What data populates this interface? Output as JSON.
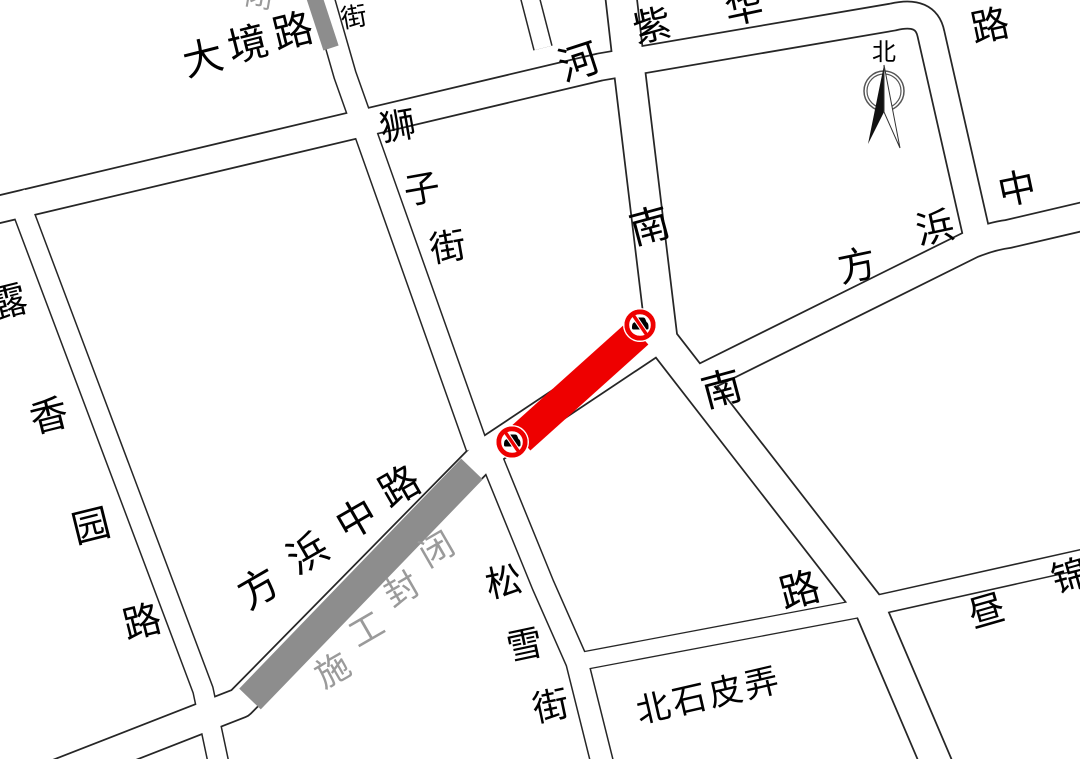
{
  "map": {
    "colors": {
      "background": "#ffffff",
      "road_outline": "#262626",
      "road_fill": "#ffffff",
      "closure_gray_band": "#8d8d8d",
      "closure_gray_text": "#9a9a9a",
      "closure_red": "#ee0000"
    },
    "compass": {
      "north_label": "北"
    },
    "closure": {
      "construction_text": "施工封闭",
      "construction_chars": [
        "施",
        "工",
        "封",
        "闭"
      ],
      "partial_top_char": "闭"
    },
    "icons": {
      "no_entry": "no-entry-sign"
    },
    "streets": {
      "dajing": {
        "name": "大境路",
        "chars": [
          "大",
          "境",
          "路"
        ]
      },
      "shizi": {
        "name": "狮子街",
        "chars": [
          "狮",
          "子",
          "街"
        ],
        "top_char": "街"
      },
      "henan": {
        "name": "河南南路",
        "chars": [
          "河",
          "南",
          "南",
          "路"
        ]
      },
      "zihua": {
        "name": "紫华路",
        "chars": [
          "紫",
          "华",
          "路"
        ]
      },
      "fangbang_west": {
        "name": "方浜中路",
        "chars": [
          "方",
          "浜",
          "中",
          "路"
        ]
      },
      "fangbang_east": {
        "chars": [
          "方",
          "浜",
          "中"
        ]
      },
      "luxiangyuan": {
        "name": "露香园路",
        "chars": [
          "露",
          "香",
          "园",
          "路"
        ]
      },
      "songxue": {
        "name": "松雪街",
        "chars": [
          "松",
          "雪",
          "街"
        ]
      },
      "beishipi": {
        "name": "北石皮弄"
      },
      "zhoujin": {
        "chars": [
          "昼",
          "锦"
        ]
      }
    }
  }
}
